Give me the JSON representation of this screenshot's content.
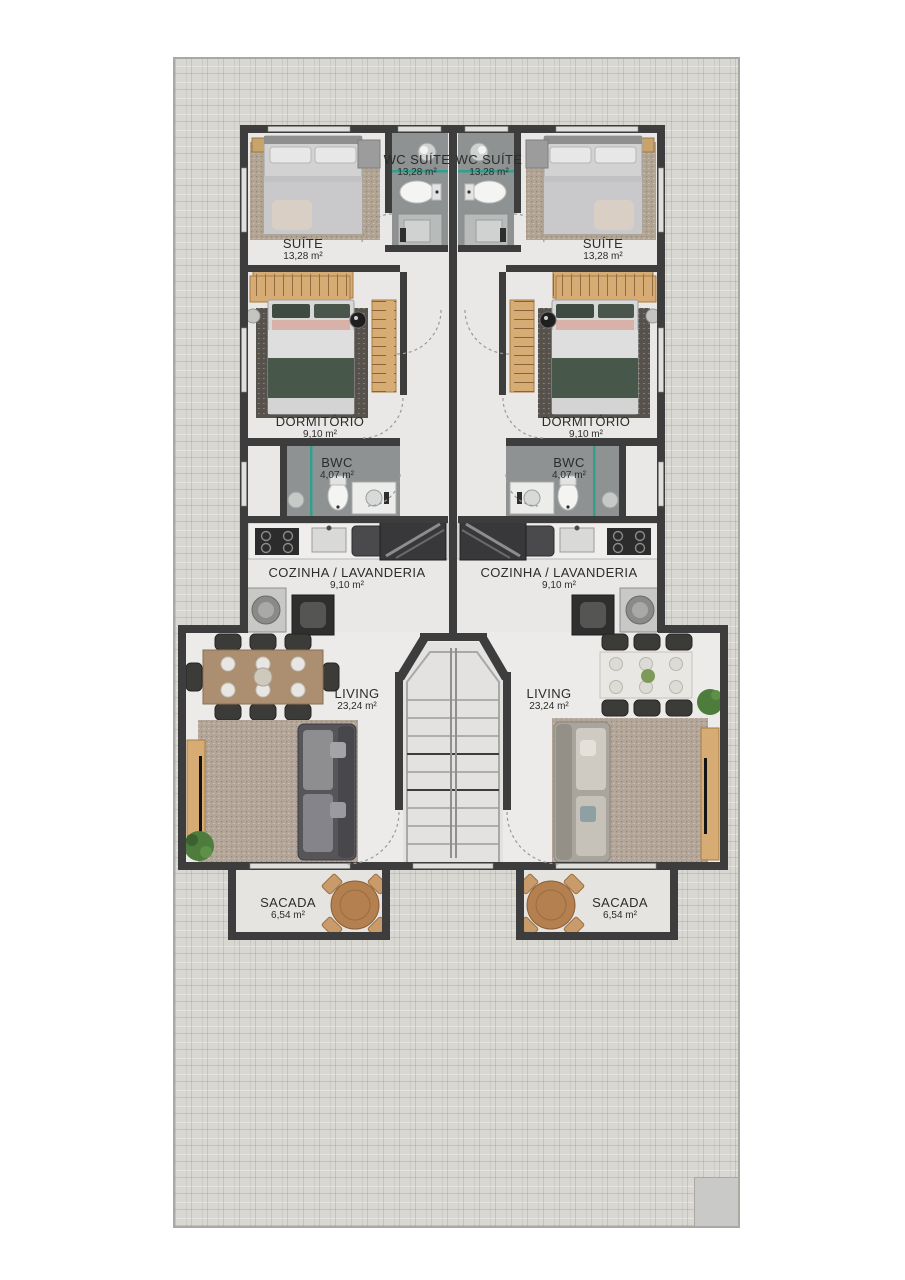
{
  "units": {
    "left": {
      "suite": {
        "name": "SUÍTE",
        "area": "13,28 m²"
      },
      "wc_suite": {
        "name": "WC SUÍTE",
        "area": "13,28 m²"
      },
      "dormitorio": {
        "name": "DORMITÓRIO",
        "area": "9,10 m²"
      },
      "bwc": {
        "name": "BWC",
        "area": "4,07 m²"
      },
      "cozinha": {
        "name": "COZINHA / LAVANDERIA",
        "area": "9,10 m²"
      },
      "living": {
        "name": "LIVING",
        "area": "23,24 m²"
      },
      "sacada": {
        "name": "SACADA",
        "area": "6,54 m²"
      }
    },
    "right": {
      "suite": {
        "name": "SUÍTE",
        "area": "13,28 m²"
      },
      "wc_suite": {
        "name": "WC SUÍTE",
        "area": "13,28 m²"
      },
      "dormitorio": {
        "name": "DORMITÓRIO",
        "area": "9,10 m²"
      },
      "bwc": {
        "name": "BWC",
        "area": "4,07 m²"
      },
      "cozinha": {
        "name": "COZINHA / LAVANDERIA",
        "area": "9,10 m²"
      },
      "living": {
        "name": "LIVING",
        "area": "23,24 m²"
      },
      "sacada": {
        "name": "SACADA",
        "area": "6,54 m²"
      }
    }
  },
  "colors": {
    "wall": "#3d3d3d",
    "interior_floor": "#e9e8e6",
    "bathroom_floor": "#8f9292",
    "glass_partition": "#2fa08e",
    "wood": "#d6ac74",
    "paving": "#d9d7d2",
    "sofa_dark": "#55555a",
    "sofa_light": "#a9a49c",
    "plant": "#4e7c3c"
  }
}
